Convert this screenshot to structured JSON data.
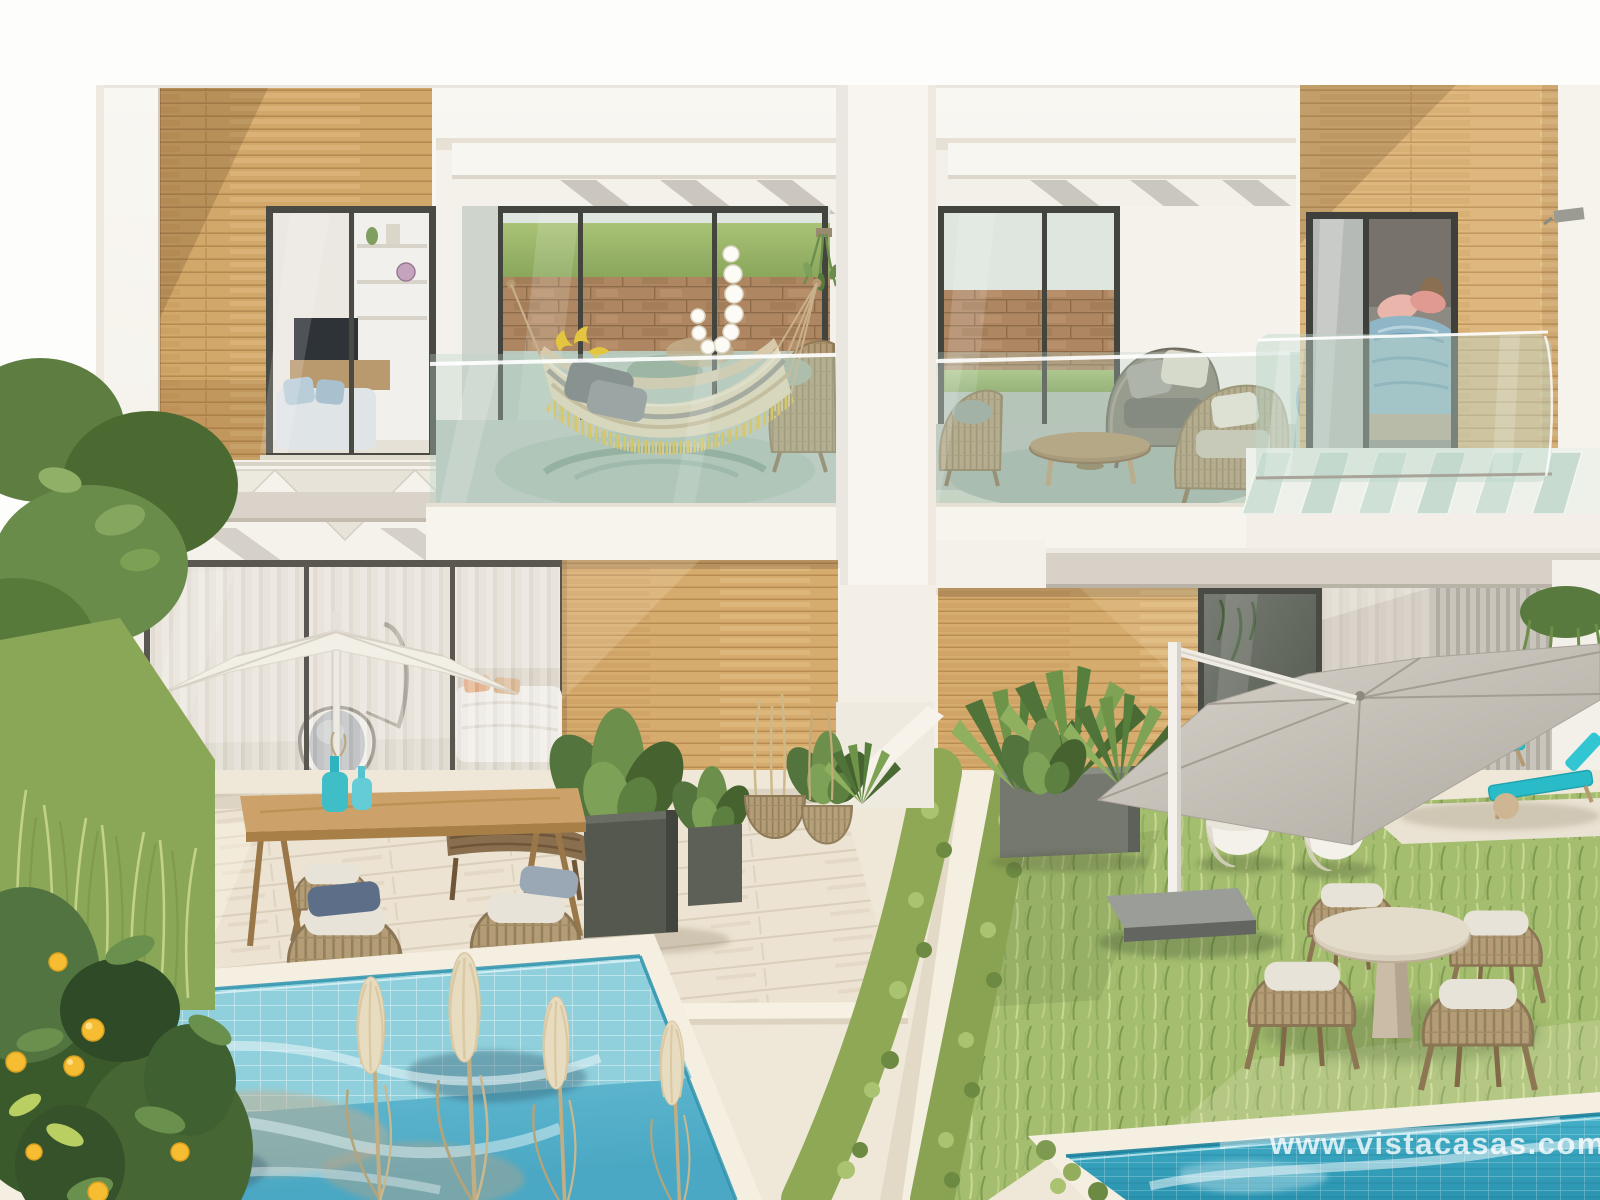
{
  "image": {
    "kind": "photorealistic architectural rendering",
    "subject": "Modern two-storey white townhouses with wood cladding, upper terraces (hammock and lounge chairs), ground-floor gardens with parasols, dining sets, lawns and two private swimming pools",
    "width_px": 1600,
    "height_px": 1200
  },
  "watermark": {
    "text": "www.vistacasas.com",
    "color": "#ffffff",
    "opacity": 0.78,
    "position": "bottom-right"
  },
  "palette": {
    "sky": "#fdfdfb",
    "facade_white": "#f7f4ef",
    "wood_cladding": "#d2a76a",
    "wood_cladding_pale": "#ddb77e",
    "glass_tint": "#cfe0d7",
    "balcony_floor": "#bcc8bf",
    "stone_wall": "#ad8762",
    "grass_hill": "#9ab864",
    "lawn": "#a4bd6f",
    "hedge": "#8fa856",
    "deck": "#ebe2d1",
    "pavement": "#efe8d9",
    "pool_left_water": "#6fbed4",
    "pool_right_water": "#2d9cb8",
    "pool_tile": "#8fd0dc",
    "umbrella_white": "#f2efe7",
    "umbrella_grey": "#c7c2b9",
    "lounger_teal": "#2ec4cf",
    "hammock_fabric": "#e6d8ba",
    "hammock_fringe": "#e2c23e",
    "bedding_blue": "#8fb6c6",
    "pillow_pink": "#e8a8a0",
    "lemon": "#f6bd33",
    "terracotta_roof": "#b06f44"
  },
  "scene": {
    "objects": [
      "building-facade",
      "wood-panel-left",
      "living-room-window",
      "pergola-zigzag",
      "balcony-hammock",
      "hammock",
      "string-lights",
      "hanging-plant",
      "wicker-lounge-chair",
      "center-pillar",
      "balcony-lounge",
      "wicker-armchair-grey",
      "wicker-armchair-tan",
      "coffee-table",
      "wood-panel-right",
      "bedroom-window",
      "juliet-glass-balcony",
      "wall-lamp",
      "glass-floor-slats",
      "concrete-beam",
      "ground-floor-glass-wall",
      "egg-chair",
      "interior-bed",
      "white-parasol",
      "dining-table",
      "dining-chairs",
      "table-vases",
      "deck",
      "planter-cubes",
      "wicker-planters",
      "wood-wall-center",
      "wood-wall-right",
      "reflective-glass-door",
      "slatted-wall",
      "hanging-plants-right",
      "grey-parasol",
      "parasol-base",
      "garden-lawn",
      "hedge-rows",
      "garden-path",
      "round-garden-table",
      "garden-chairs",
      "white-plant-pots",
      "grey-planter-box",
      "sun-loungers",
      "patio",
      "pool-left",
      "pool-right",
      "pool-coping",
      "pampas-grass",
      "lemon-tree",
      "tree-canopy",
      "tall-grass",
      "terracotta-roof",
      "watermark"
    ]
  }
}
